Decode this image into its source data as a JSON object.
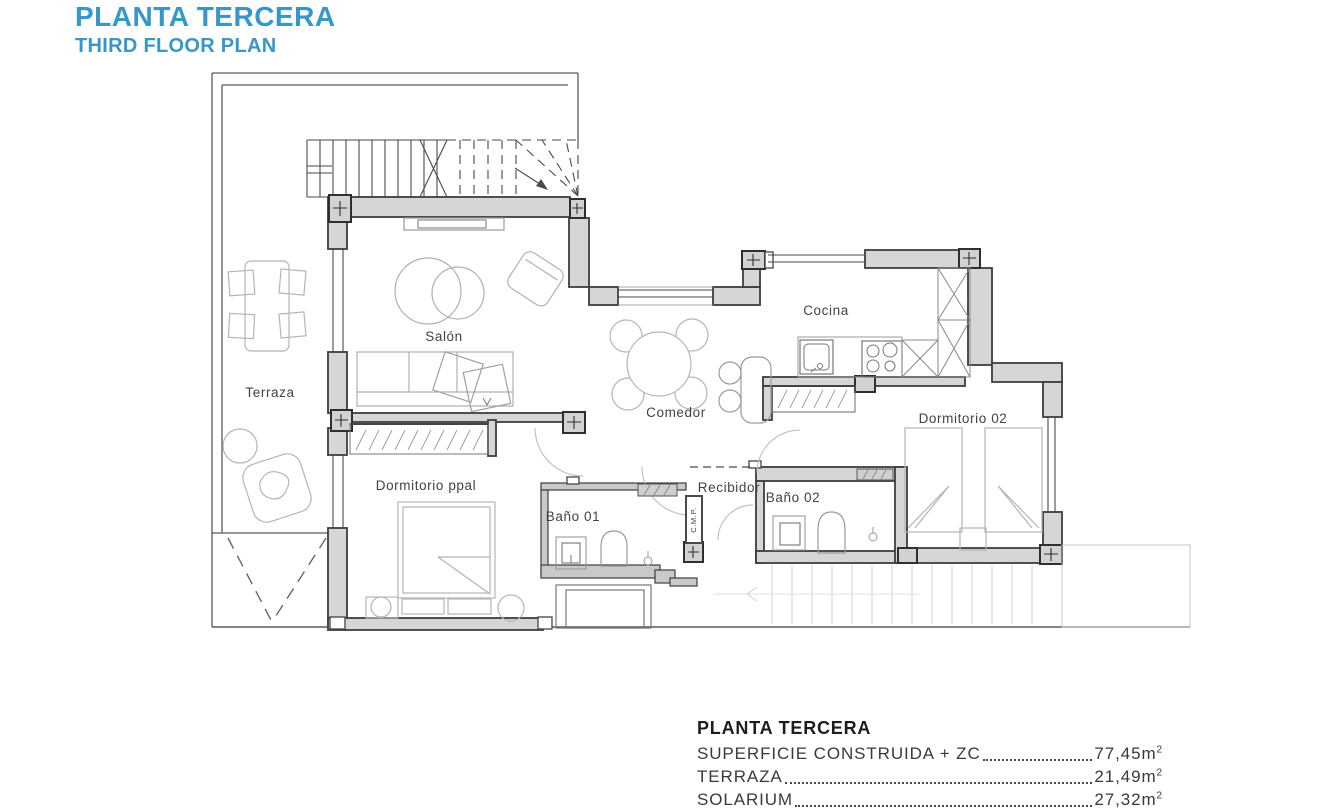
{
  "title": {
    "main": "PLANTA TERCERA",
    "sub": "THIRD FLOOR PLAN"
  },
  "colors": {
    "accent_blue": "#3697c8",
    "wall_fill": "#d6d6d6",
    "wall_line": "#3e3e3e",
    "furniture_line": "#b5b5b5"
  },
  "plan": {
    "rooms": [
      {
        "label": "Terraza"
      },
      {
        "label": "Salón"
      },
      {
        "label": "Cocina"
      },
      {
        "label": "Comedor"
      },
      {
        "label": "Dormitorio ppal"
      },
      {
        "label": "Baño 01"
      },
      {
        "label": "Recibidor"
      },
      {
        "label": "Baño 02"
      },
      {
        "label": "Dormitorio 02"
      },
      {
        "label": "C.M.P."
      }
    ]
  },
  "area_table": {
    "heading": "PLANTA TERCERA",
    "rows": [
      {
        "label": "SUPERFICIE CONSTRUIDA + ZC",
        "value": "77,45m",
        "sup": "2"
      },
      {
        "label": "TERRAZA",
        "value": "21,49m",
        "sup": "2"
      },
      {
        "label": "SOLARIUM",
        "value": "27,32m",
        "sup": "2"
      }
    ]
  }
}
